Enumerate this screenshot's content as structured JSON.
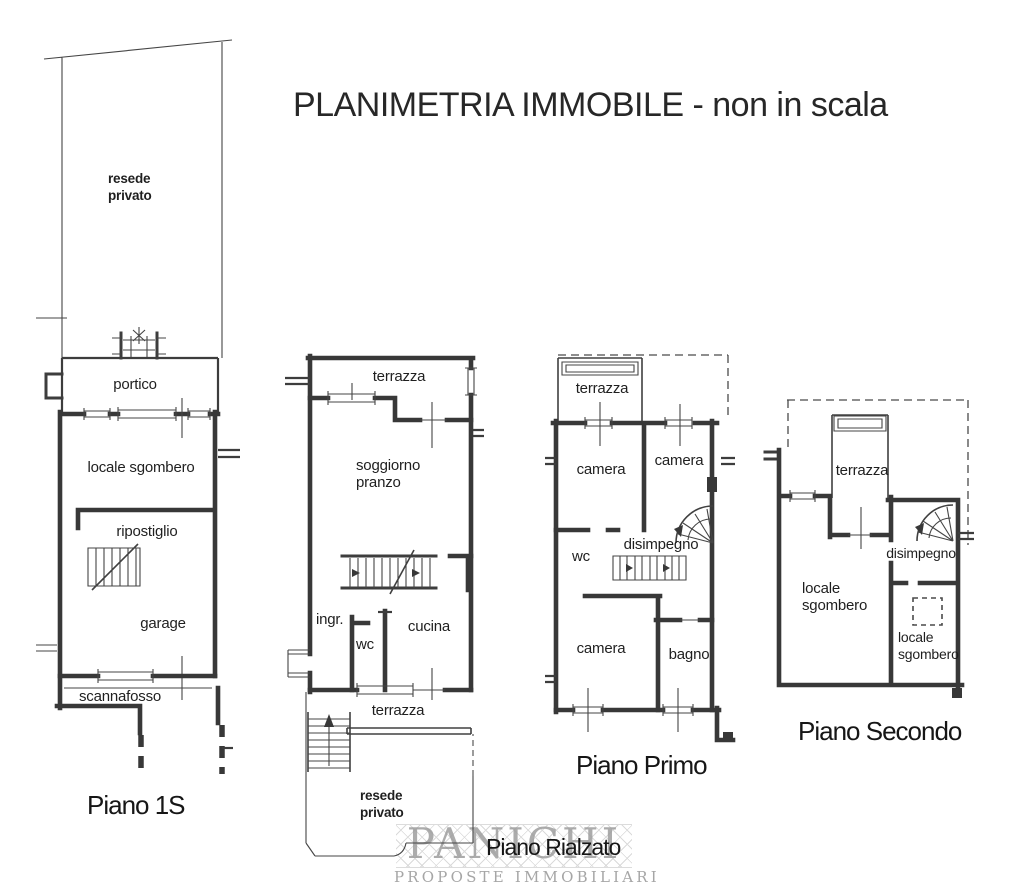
{
  "title": "PLANIMETRIA IMMOBILE - non in scala",
  "colors": {
    "line": "#3d3d3d",
    "paper": "#ffffff",
    "watermark": "#9e9e9e"
  },
  "floors": {
    "piano_1s": {
      "label": "Piano 1S",
      "rooms": {
        "resede_privato": "resede\nprivato",
        "portico": "portico",
        "locale_sgombero": "locale sgombero",
        "ripostiglio": "ripostiglio",
        "garage": "garage",
        "scannafosso": "scannafosso"
      }
    },
    "piano_rialzato": {
      "label": "Piano Rialzato",
      "rooms": {
        "terrazza_nord": "terrazza",
        "soggiorno_pranzo": "soggiorno\npranzo",
        "ingresso": "ingr.",
        "wc": "wc",
        "cucina": "cucina",
        "terrazza_sud": "terrazza",
        "resede_privato": "resede\nprivato"
      }
    },
    "piano_primo": {
      "label": "Piano Primo",
      "rooms": {
        "terrazza": "terrazza",
        "camera_nord_ovest": "camera",
        "camera_nord_est": "camera",
        "wc": "wc",
        "disimpegno": "disimpegno",
        "camera_sud": "camera",
        "bagno": "bagno"
      }
    },
    "piano_secondo": {
      "label": "Piano Secondo",
      "rooms": {
        "terrazza": "terrazza",
        "disimpegno": "disimpegno",
        "locale_sgombero_ovest": "locale\nsgombero",
        "locale_sgombero_est": "locale\nsgombero"
      }
    }
  },
  "watermark": {
    "name": "PANICHI",
    "tagline": "PROPOSTE IMMOBILIARI"
  }
}
